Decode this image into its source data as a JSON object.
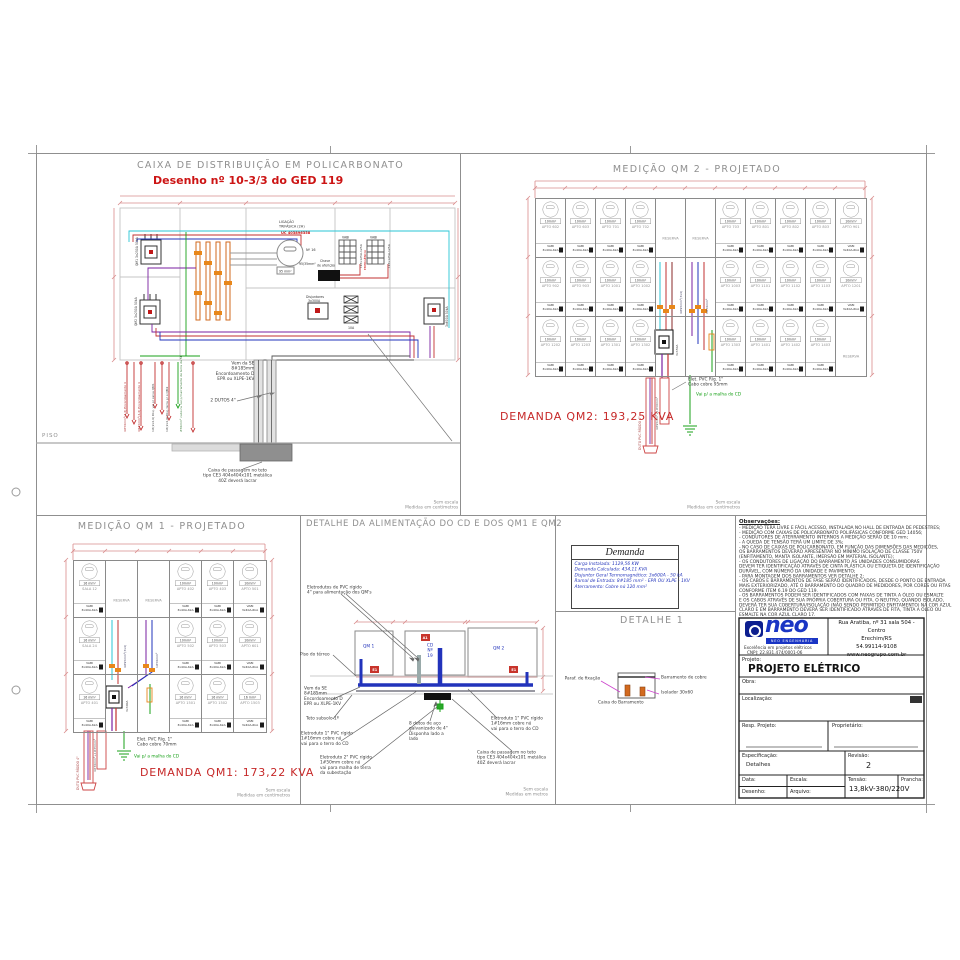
{
  "colors": {
    "red": "#c62828",
    "dim_red": "#d98c8c",
    "blue": "#2233bb",
    "cad_grey": "#8f8f8f",
    "green": "#18a018",
    "cyan": "#2ac6d6",
    "purple": "#7a1fa0",
    "orange": "#d2691e",
    "brand_blue": "#1a35c4"
  },
  "sheet": {
    "cd": {
      "title": "CAIXA DE DISTRIBUIÇÃO EM POLICARBONATO",
      "subtitle": "Desenho nº 10-3/3 do GED 119",
      "ligacao1": "LIGAÇÃO",
      "ligacao2": "TRIFÁSICA (2H)",
      "uc": "UC 403896358",
      "medidor_n": "Nº 16",
      "cable95": "95 mm²",
      "cable9535": "95/35mm²",
      "chave1": "Chave",
      "chave2": "de aferição",
      "vabi": "VABI",
      "bank1": "I.L3x125A-125A",
      "bank2": "I.L3x125A-125A",
      "emergencia": "EMERGÊNCIA",
      "disj_c1": "Disjuntores",
      "disj_c2": "3x300A",
      "tc": "10A",
      "disj_qm1": "QM1 3x250A 50kA",
      "disj_qm2": "QM2 3x250A 50kA",
      "disj_geral": "3x600A 50kA",
      "pin1": "4#50mm²(4,6) Encordoamento 4",
      "pin2": "4#35mm²(4,6) Encordoamento 4",
      "pin3": "1#(2x4,6) Disj. vai p/ caixa QM1",
      "pin4": "1#(2x4,6) Disj. terra p/ o QM2",
      "pin5": "#50mm² cabo nu vai p/ barramento de terra da SE",
      "vem_da_se": "Vem da SE\n8#185mm\nEncordoamento D\nEPR ou XLPE-1KV",
      "dutos": "2 DUTOS 4\"",
      "piso": "PISO",
      "caixa_passagem": "Caixa de passagem no teto\ntipo CE3 404x404x101 metálica\n40Z deverá lacrar",
      "sem_escala": "Sem escala",
      "medidas": "Medidas em centímetros"
    },
    "qm2": {
      "title": "MEDIÇÃO QM 2 - PROJETADO",
      "rows": [
        [
          "APTO 602",
          "APTO 603",
          "APTO 701",
          "APTO 702",
          "RESERVA",
          "RESERVA",
          "APTO 703",
          "APTO 801",
          "APTO 802",
          "APTO 803",
          "APTO 901"
        ],
        [
          "APTO 902",
          "APTO 903",
          "APTO 1001",
          "APTO 1002",
          "",
          "",
          "APTO 1003",
          "APTO 1101",
          "APTO 1102",
          "APTO 1103",
          "APTO 1201"
        ],
        [
          "APTO 1202",
          "APTO 1203",
          "APTO 1301",
          "APTO 1302",
          "",
          "",
          "APTO 1303",
          "APTO 1401",
          "APTO 1402",
          "APTO 1403",
          "RESERVA"
        ]
      ],
      "wire_default": "10mm²",
      "wire_overrides": {},
      "vabi": "VABI",
      "breaker": "3x40A-6kA",
      "riser_label1": "4#95mm²(3x4)",
      "riser_label2": "1#50mm²",
      "disj_label": "3x350A",
      "duto_label": "DUTO PVC RÍGIDO 4\"",
      "cabo_label": "4#95mm²+1#50mm²",
      "elet_note": "Elet. PVC Ríg. 1\"\nCabo cobre 95mm",
      "terra_note": "Vai p/ a malha do CD",
      "demanda": "DEMANDA QM2: 193,25 KVA",
      "sem_escala": "Sem escala",
      "medidas": "Medidas em centímetros"
    },
    "qm1": {
      "title": "MEDIÇÃO QM 1 - PROJETADO",
      "rows": [
        [
          "SALA 12",
          "RESERVA",
          "RESERVA",
          "APTO 402",
          "APTO 403",
          "APTO 501"
        ],
        [
          "SALA 24",
          "",
          "",
          "APTO 502",
          "APTO 503",
          "APTO 601"
        ],
        [
          "APTO 401",
          "",
          "",
          "APTO 1501",
          "APTO 1502",
          "APTO 1503"
        ]
      ],
      "wire_default": "10mm²",
      "wire_overrides": {
        "SALA 12": "16 mm²",
        "SALA 24": "16 mm²",
        "APTO 401": "16 mm²",
        "APTO 1501": "16 mm²",
        "APTO 1502": "16 mm²",
        "APTO 1503": "16 mm²"
      },
      "vabi": "VABI",
      "breaker": "3x40A-6kA",
      "riser_label1": "4#95mm²(3x4)",
      "riser_label2": "1#50mm²",
      "disj_label": "3x300A",
      "duto_label": "DUTO PVC RÍGIDO 4\"",
      "cabo_label": "4#70mm²+1#35mm²",
      "elet_note": "Elet. PVC Ríg. 1\"\nCabo cobre 70mm",
      "terra_note": "Vai p/ a malha do CD",
      "demanda": "DEMANDA QM1: 173,22 KVA",
      "sem_escala": "Sem escala",
      "medidas": "Medidas em centímetros"
    },
    "detalhe_alim": {
      "title": "DETALHE DA ALIMENTAÇÃO DO CD E DOS QM1 E QM2",
      "box_qm1": "QM 1",
      "box_cd": "CD\nNº 19",
      "box_qm2": "QM 2",
      "marker_a": "A1",
      "marker_b": "E1",
      "marker_c": "E1",
      "ann_eletrodutos": "Eletrodutos de PVC rígido\n4\" para alimentação dos QM's",
      "ann_piso": "Piso do térreo",
      "ann_vem": "Vem da SE\n8#185mm\nEncordoamento D\nEPR ou XLPE-1KV",
      "ann_teto": "Teto subsolo 1º",
      "ann_elet1": "Eletroduto 1\" PVC rígido\n1#16mm cobre nú\nvai para o terro do CD",
      "ann_elet2": "Eletroduto 2\" PVC rígido\n1#50mm cobre nú\nvai para malha de terra\nda subestação",
      "ann_dutos": "8 dutos de aço\ngalvanizado de 4\"\nDisponha lado a\nlado",
      "ann_elet3": "Eletroduto 1\" PVC rígido\n1#16mm cobre nú\nvai para o terro do CD",
      "ann_caixa": "Caixa de passagem no teto\ntipo CE3 404x404x101 metálica\n40Z deverá lacrar",
      "sem_escala": "Sem escala",
      "medidas": "Medidas em metros"
    },
    "demanda_tbl": {
      "title": "Demanda",
      "rows": [
        "Carga Instalada: 1129,56 KW",
        "Demanda Calculada: 434,11 KVA",
        "Disjuntor Geral Termomagnético: 3x600A - 50 kA",
        "Ramal de Entrada: 8#185 mm² - EPR OU XLPE - 1KV",
        "Aterramento: Cobre nú 120 mm²"
      ]
    },
    "detalhe1": {
      "title": "DETALHE 1",
      "paraf": "Paraf. de fixação",
      "barramento": "Barramento de cobre",
      "isolador": "Isolador 30x60",
      "caixa": "Caixa do Barramento"
    },
    "observacoes": {
      "title": "Observações:",
      "lines": [
        "- MEDIÇÃO TERÁ LIVRE E FÁCIL ACESSO, INSTALADA NO HALL DE ENTRADA DE PEDESTRES;",
        "- MEDIÇÃO COM CAIXAS DE POLICARBONATO POLIFÁSICAS CONFORME GED 14056;",
        "- CONDUTORES DE ATERRAMENTO INTERNOS A MEDIÇÃO SERÃO DE 10 mm;",
        "- A QUEDA DE TENSÃO TERÁ UM LIMITE DE 3%;",
        "- NO CASO DE CAIXAS DE POLICARBONATO, EM FUNÇÃO DAS DIMENSÕES DAS MEDIÇÕES,",
        "OS BARRAMENTOS DEVERÃO APRESENTAR NO MÍNIMO ISOLAÇÃO DE CLASSE 750V",
        "(ENFITAMENTO, MANTA ISOLANTE, IMERSÃO EM MATERIAL ISOLANTE);",
        "- OS CONDUTORES DE LIGAÇÃO DO BARRAMENTO ÀS UNIDADES CONSUMIDORAS",
        "DEVEM TER IDENTIFICAÇÃO ATRAVÉS DE CINTA PLÁSTICA OU ETIQUETA DE IDENTIFICAÇÃO",
        "DURÁVEL, COM NÚMERO DA UNIDADE E PAVIMENTO;",
        "- PARA MONTAGEM DOS BARRAMENTOS VER DETALHE 2;",
        "- OS CABOS E BARRAMENTOS DE FASE SERÃO IDENTIFICADOS, DESDE O PONTO DE ENTRADA",
        "MAIS EXTERIORIZADO, ATÉ O BARRAMENTO DO QUADRO DE MEDIDORES, POR CORES OU FITAS",
        "CONFORME ITEM 6.19 DO GED 119.",
        "- OS BARRAMENTOS PODEM SER IDENTIFICADOS COM FAIXAS DE TINTA A ÓLEO OU ESMALTE",
        "E OS CABOS ATRAVÉS DE SUA PRÓPRIA COBERTURA OU FITA. O NEUTRO, QUANDO ISOLADO,",
        "DEVERÁ TER SUA COBERTURA/ISOLAÇÃO (NÃO SENDO PERMITIDO ENFITAMENTO) NA COR AZUL",
        "CLARO E EM BARRAMENTO DEVERÁ SER IDENTIFICADO ATRAVÉS DE FITA, TINTA A ÓLEO OU",
        "ESMALTE NA COR AZUL CLARO 17."
      ]
    },
    "titleblock": {
      "brand": "neo",
      "brand_sub": "NEO ENGENHARIA",
      "brand_tag": "Excelência em projetos elétricos",
      "cnpj": "CNPJ: 22.831.474/0001-06",
      "address": "Rua Aratiba, nº 31 sala 504 - Centro\nErechim/RS\n54.99114-9108\nwww.neogrupo.com.br",
      "projeto_label": "Projeto:",
      "projeto": "PROJETO ELÉTRICO",
      "obra_label": "Obra:",
      "localizacao_label": "Localização:",
      "resp_label": "Resp. Projeto:",
      "prop_label": "Proprietário:",
      "espec_label": "Especificação:",
      "espec_value": "Detalhes",
      "revisao_label": "Revisão:",
      "revisao_value": "2",
      "data_label": "Data:",
      "des_label": "Desenho:",
      "escala_label": "Escala:",
      "arquivo_label": "Arquivo:",
      "tensao_label": "Tensão:",
      "tensao_value": "13,8kV-380/220V",
      "prancha_label": "Prancha:"
    }
  }
}
